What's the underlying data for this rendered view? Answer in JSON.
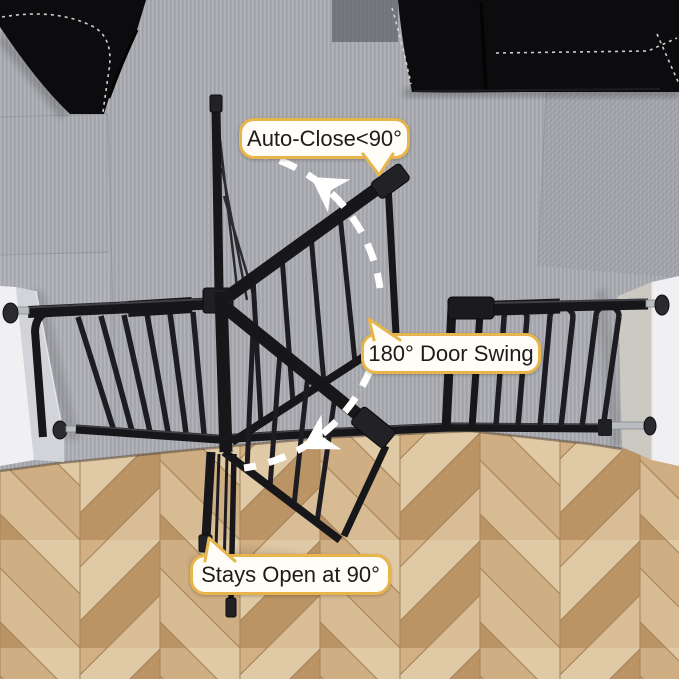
{
  "callouts": {
    "auto_close": {
      "label": "Auto-Close<90°"
    },
    "door_swing": {
      "label": "180° Door Swing"
    },
    "stays_open": {
      "label": "Stays Open at 90°"
    }
  },
  "icons": {
    "swing_arrow": "tapered white arrowhead on dashed swing arc",
    "callout_tail": "speech-bubble pointer triangle"
  },
  "colors": {
    "bubble_border": "#e8b54c",
    "bubble_fill": "#fffdf6",
    "text_color": "#1c1c1c",
    "gate_black": "#17171a",
    "carpet": "#a6a8ae",
    "carpet_rib": "#b4b6bb",
    "carpet_rib_dark": "#97999f",
    "wood_light": "#e0caa6",
    "wood_mid": "#cfae83",
    "wood_dark": "#bb9466",
    "wall_left": "#d2d4da",
    "wall_right": "#cbc9c1",
    "wall_white": "#f0f0f2",
    "arc_white": "#ffffff",
    "sofa_black": "#0c0c0e",
    "stitch": "#d8d8d8",
    "metal_silver": "#b9bcc0"
  }
}
